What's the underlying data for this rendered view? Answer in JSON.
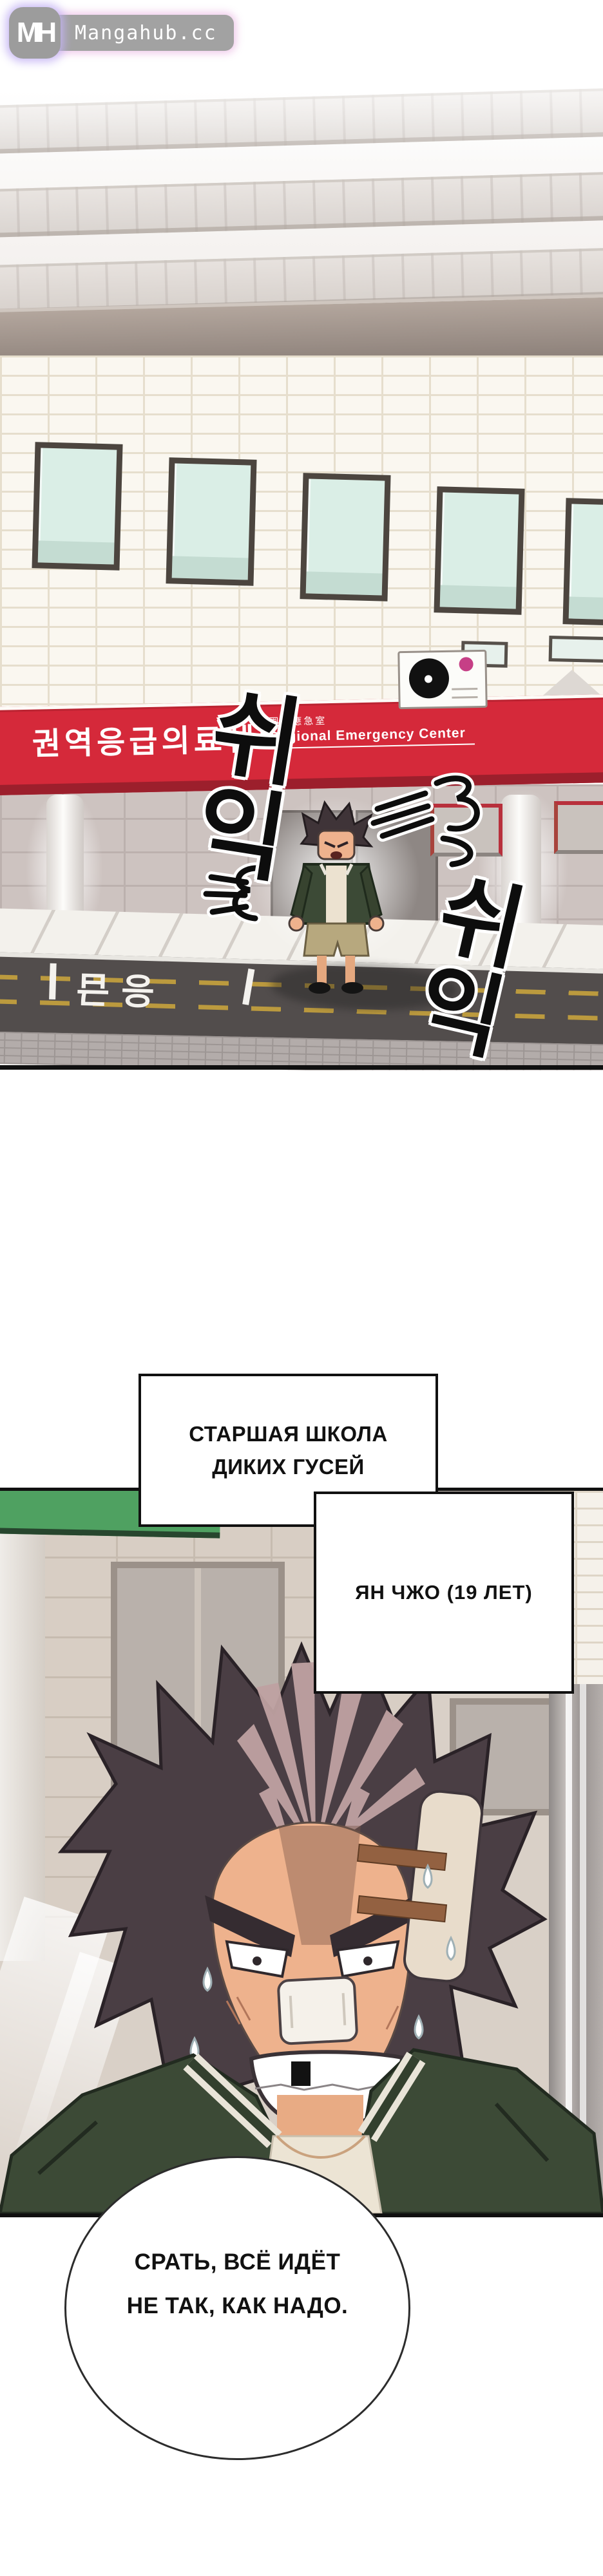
{
  "site": {
    "logo_monogram": "MH",
    "logo_domain": "Mangahub.cc"
  },
  "panel_street": {
    "banner": {
      "korean_title": "권역응급의료센터",
      "hanja_subtitle": "圈域應急室",
      "english_subtitle": "Regional Emergency Center"
    },
    "sfx": {
      "hiss_left": "쉬익",
      "hiss_right": "쉬익"
    },
    "road_marking": "응급"
  },
  "caption_boxes": {
    "school": "СТАРШАЯ ШКОЛА ДИКИХ ГУСЕЙ",
    "character": "ЯН ЧЖО (19 ЛЕТ)"
  },
  "speech_bubble": {
    "line1": "СРАТЬ, ВСЁ ИДЁТ",
    "line2": "НЕ ТАК, КАК НАДО."
  },
  "colors": {
    "banner_red": "#d5293a",
    "banner_dark_red": "#9c1f2c",
    "jacket_green": "#3c4a36",
    "roof_green": "#4fa161",
    "window_mint": "#daeee6",
    "logo_gray": "#9f9f9f"
  }
}
